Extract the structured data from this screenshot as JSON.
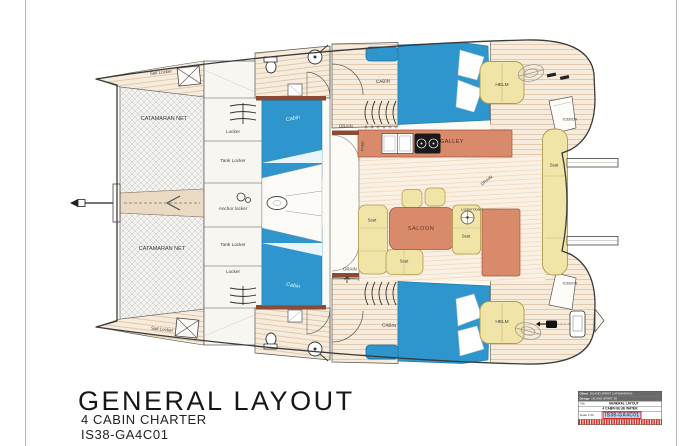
{
  "drawing_title": {
    "main": "GENERAL LAYOUT",
    "line2": "4 CABIN CHARTER",
    "line3": "IS38-GA4C01"
  },
  "labels": {
    "sail_locker_top": "Sail Locker",
    "sail_locker_bottom": "Sail Locker",
    "catamaran_net_top": "CATAMARAN NET",
    "catamaran_net_bottom": "CATAMARAN NET",
    "locker_top": "Locker",
    "tank_locker_top": "Tank Locker",
    "anchor_locker": "Anchor locker",
    "tank_locker_bottom": "Tank Locker",
    "locker_bottom": "Locker",
    "cabin_fore_top": "Cabin",
    "cabin_fore_bottom": "Cabin",
    "cabin_aft_top": "CABIN",
    "cabin_aft_bottom": "CABIN",
    "galley": "GALLEY",
    "fridge": "Fridge",
    "drain_top": "DRAIN",
    "drain_right": "DRAIN",
    "drain_bottom": "DRAIN",
    "saloon": "SALOON",
    "seat_left": "Seat",
    "seat_right": "Seat",
    "seat_bottom": "Seat",
    "locker_board": "Locker board",
    "helm_top": "HELM",
    "helm_bottom": "HELM",
    "icebox_top": "ICEBOX",
    "icebox_bottom": "ICEBOX",
    "seat_aft": "Seat"
  },
  "title_block": {
    "client_label": "Client",
    "client_value": "ISLAND SPIRIT CATAMARANS",
    "design_label": "Design",
    "design_value": "ISLAND SPIRIT 38",
    "title_label": "Title",
    "title_line1": "GENERAL LAYOUT",
    "title_line2": "4 CABIN BLUE WATER",
    "scale_text": "Scale 1:50",
    "drawing_number": "IS38-GA4C01"
  },
  "colors": {
    "cabin_blue": "#2e96cd",
    "furniture_salmon": "#d98a6b",
    "seat_yellow": "#f1e4a7",
    "wall_brown": "#8a4a33"
  }
}
